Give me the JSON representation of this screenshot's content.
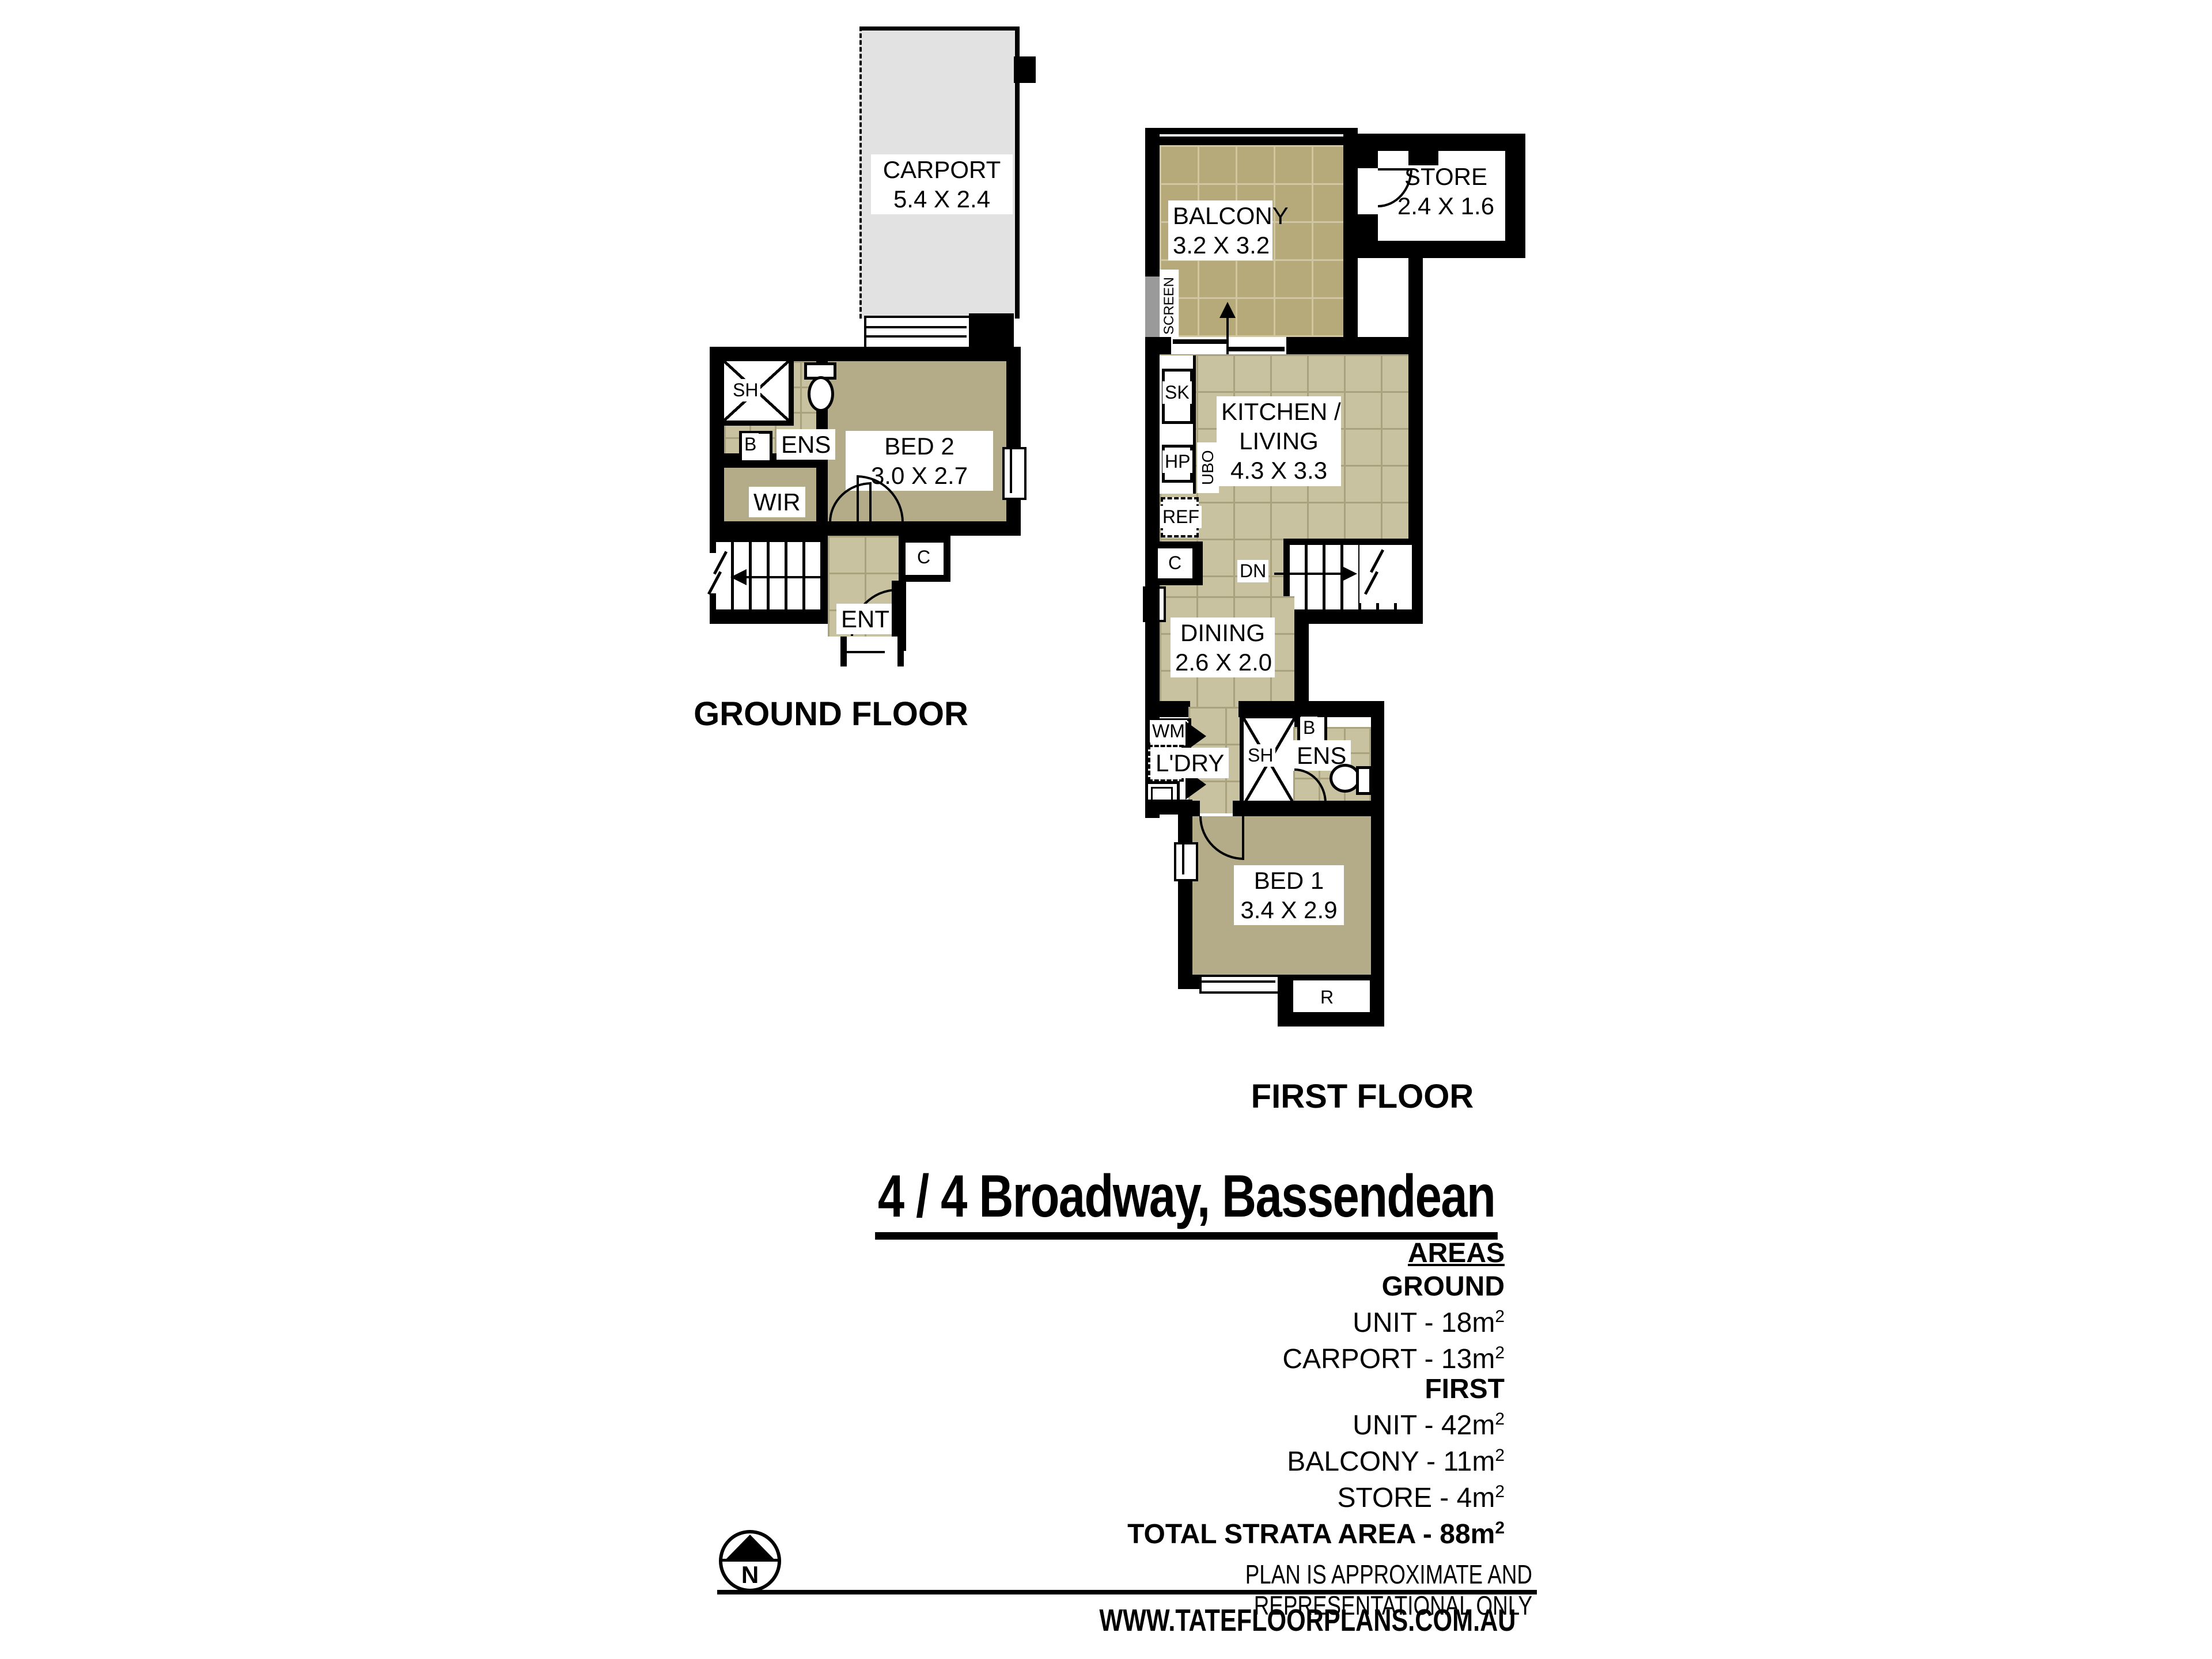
{
  "ground_floor": {
    "label": "GROUND FLOOR",
    "carport": {
      "name": "CARPORT",
      "dims": "5.4 X 2.4"
    },
    "bed2": {
      "name": "BED 2",
      "dims": "3.0 X 2.7"
    },
    "ens": "ENS",
    "wir": "WIR",
    "ent": "ENT",
    "sh": "SH",
    "b": "B",
    "c": "C",
    "up": "UP"
  },
  "first_floor": {
    "label": "FIRST FLOOR",
    "balcony": {
      "name": "BALCONY",
      "dims": "3.2 X 3.2"
    },
    "store": {
      "name": "STORE",
      "dims": "2.4 X 1.6"
    },
    "kitchen": {
      "name1": "KITCHEN /",
      "name2": "LIVING",
      "dims": "4.3 X 3.3"
    },
    "dining": {
      "name": "DINING",
      "dims": "2.6 X 2.0"
    },
    "bed1": {
      "name": "BED 1",
      "dims": "3.4 X 2.9"
    },
    "ens": "ENS",
    "ldry": "L'DRY",
    "screen": "SCREEN",
    "sk": "SK",
    "hp": "HP",
    "ubo": "UBO",
    "ref": "REF",
    "c": "C",
    "dn": "DN",
    "wm": "WM",
    "sh": "SH",
    "b": "B",
    "r": "R"
  },
  "title": "4 / 4 Broadway, Bassendean",
  "areas": {
    "heading": "AREAS",
    "ground_heading": "GROUND",
    "ground_rows": [
      {
        "text": "UNIT - 18m",
        "sup": "2"
      },
      {
        "text": "CARPORT - 13m",
        "sup": "2"
      }
    ],
    "first_heading": "FIRST",
    "first_rows": [
      {
        "text": "UNIT - 42m",
        "sup": "2"
      },
      {
        "text": "BALCONY - 11m",
        "sup": "2"
      },
      {
        "text": "STORE - 4m",
        "sup": "2"
      }
    ],
    "total": {
      "text": "TOTAL STRATA AREA - 88m",
      "sup": "2"
    }
  },
  "compass": {
    "n": "N"
  },
  "footer": {
    "disclaimer": "PLAN IS APPROXIMATE AND REPRESENTATIONAL ONLY",
    "website": "WWW.TATEFLOORPLANS.COM.AU"
  }
}
